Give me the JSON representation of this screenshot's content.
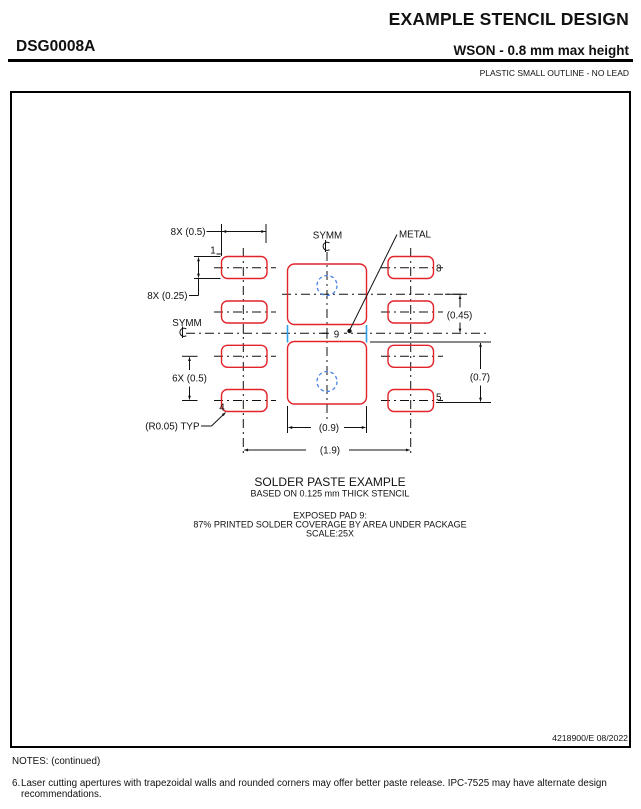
{
  "header": {
    "title": "EXAMPLE STENCIL DESIGN",
    "package_code": "DSG0008A",
    "subtitle": "WSON - 0.8 mm max height",
    "package_type": "PLASTIC SMALL OUTLINE - NO LEAD"
  },
  "drawing": {
    "labels": {
      "dim_pad_width": "8X (0.5)",
      "dim_pad_height": "8X (0.25)",
      "dim_pad_pitch": "6X (0.5)",
      "dim_045": "(0.45)",
      "dim_07": "(0.7)",
      "dim_09": "(0.9)",
      "dim_19": "(1.9)",
      "radius_typ": "(R0.05) TYP",
      "symm_top": "SYMM",
      "symm_left": "SYMM",
      "metal": "METAL",
      "pin1": "1",
      "pin4": "4",
      "pin5": "5",
      "pin8": "8",
      "pad9": "9"
    },
    "colors": {
      "aperture_outline": "#E2232A",
      "metal_edge": "#2D9FE6",
      "paste_mark": "#4C82E8",
      "line": "#111111"
    }
  },
  "caption": {
    "title": "SOLDER PASTE EXAMPLE",
    "subtitle": "BASED ON 0.125 mm THICK STENCIL",
    "exposed_pad": "EXPOSED PAD 9:",
    "coverage": "87% PRINTED SOLDER COVERAGE BY AREA UNDER PACKAGE",
    "scale": "SCALE:25X"
  },
  "footer": {
    "doc_number": "4218900/E   08/2022"
  },
  "notes": {
    "heading": "NOTES: (continued)",
    "note6_number": "6.",
    "note6_text": "Laser cutting apertures with trapezoidal walls and rounded corners may offer better paste release. IPC-7525 may have alternate design recommendations."
  }
}
